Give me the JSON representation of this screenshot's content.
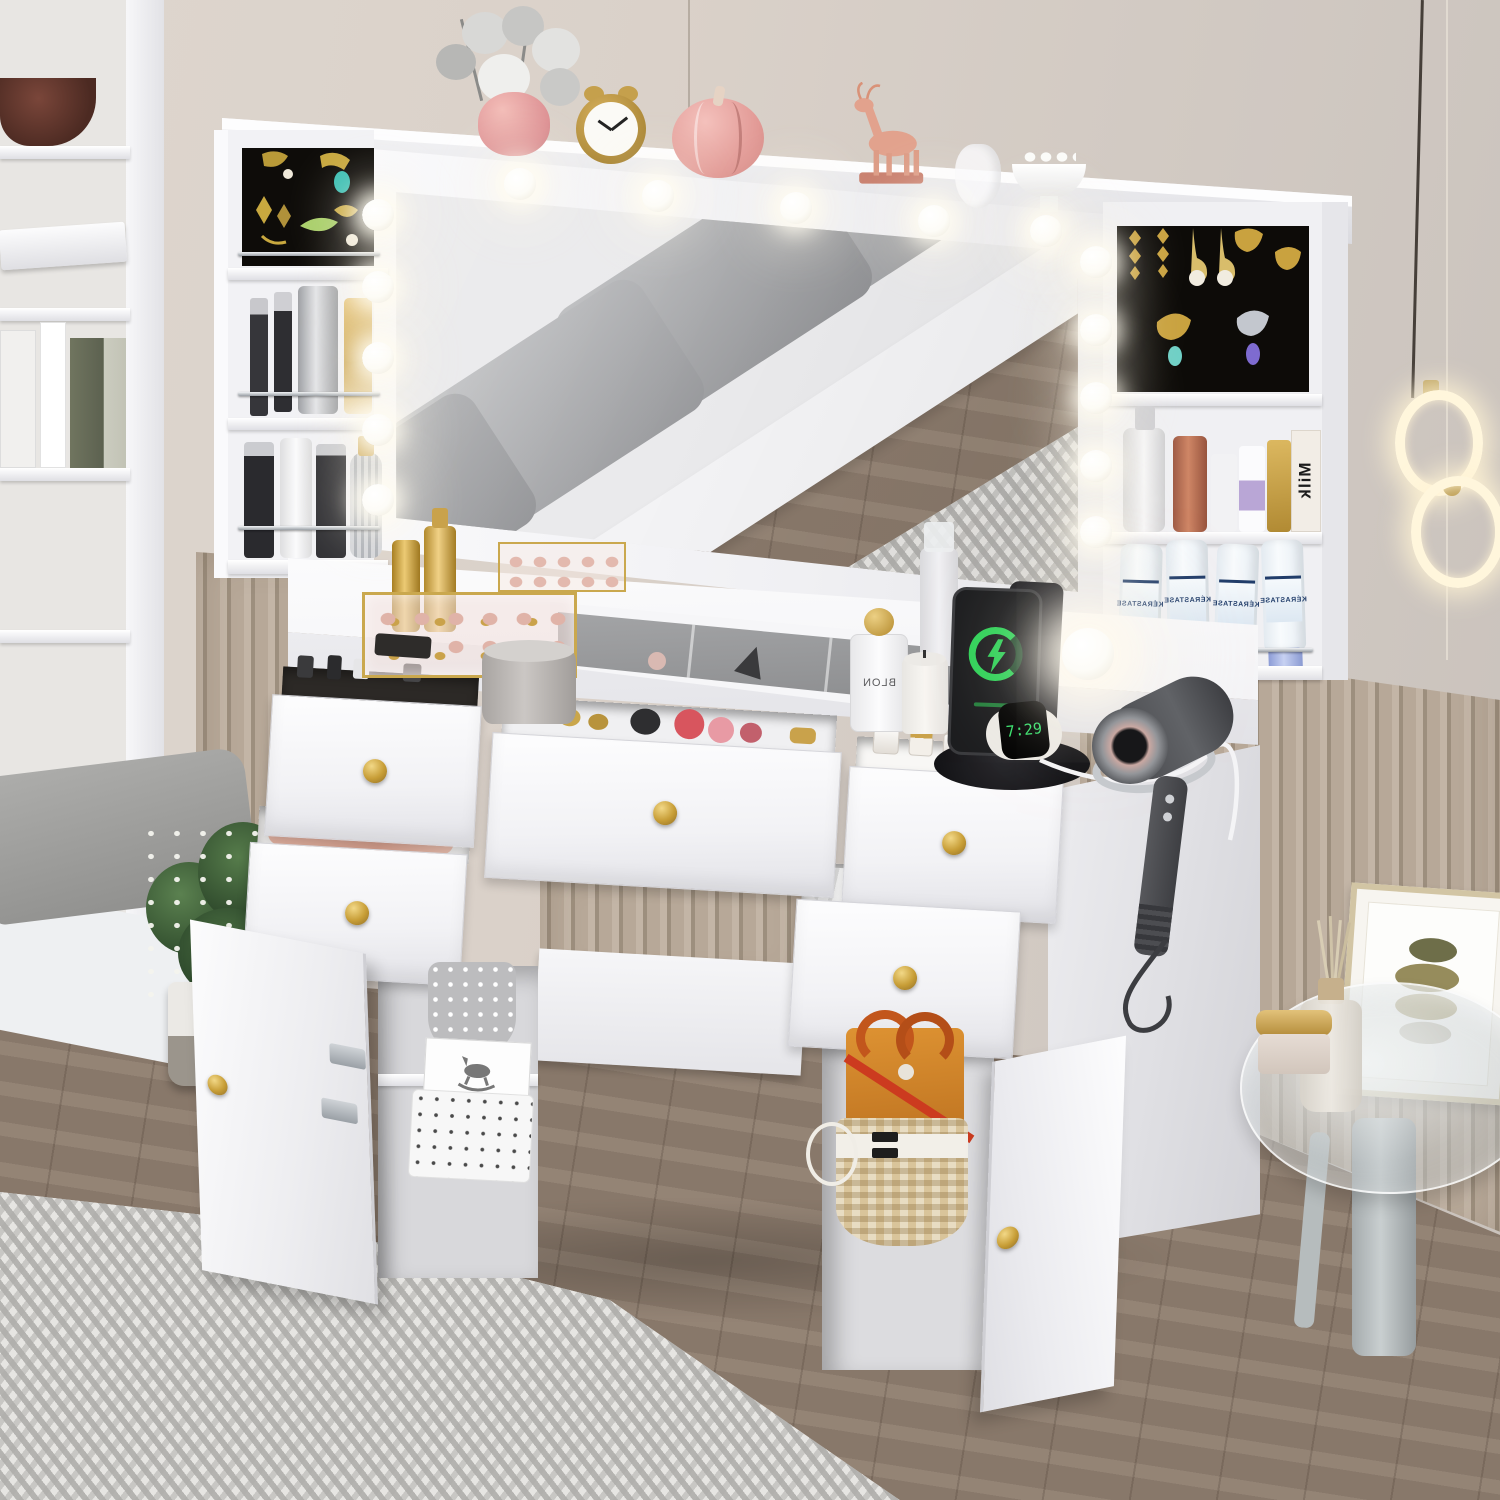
{
  "meta": {
    "scene_type": "product-photo",
    "subject": "White makeup vanity desk set with Hollywood lighted mirror, jewelry niches, open drawers and cabinets in a beige bedroom"
  },
  "texts": {
    "watch_time": "7:29",
    "shampoo_brand": "KÉRASTASE",
    "milk_label": "Milk",
    "perfume_label": "BLON",
    "clock_time": "10:10"
  },
  "palette": {
    "wall": "#d8cfc7",
    "slat_wall": "#b3a395",
    "wood_floor": "#8e7d6e",
    "rug": "#dcdbd8",
    "furniture_white": "#f7f7f9",
    "accent_gold": "#c9a24b",
    "jewelry_backdrop": "#0d0b08",
    "charging_green": "#2fd158",
    "kerastase_cap_blue": "#9fb0e6",
    "bag_orange": "#d98a2b",
    "pumpkin_pink": "#e9a19c",
    "cushion_gray": "#9a9b9d"
  },
  "counts": {
    "led_bulbs_visible": 15,
    "open_drawers": 5,
    "open_doors": 2,
    "kerastase_bottles": 4,
    "mirror_cushion_segments": 4
  }
}
